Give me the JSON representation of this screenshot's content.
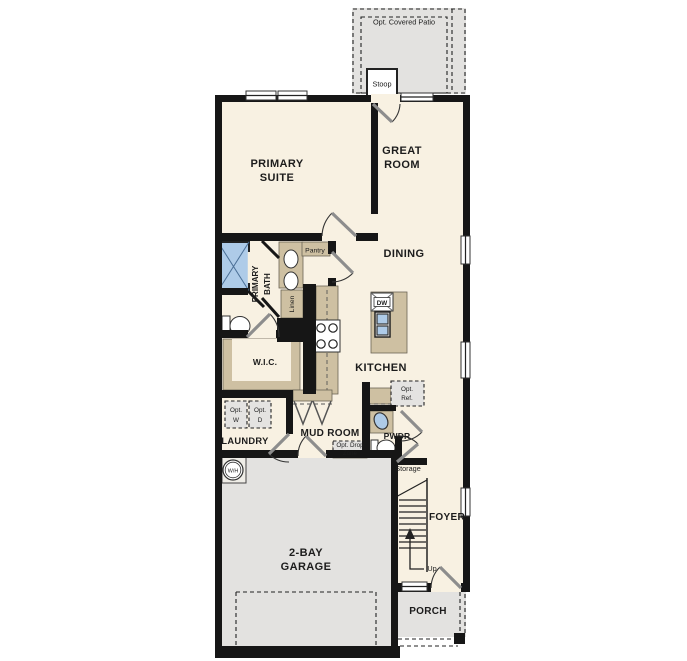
{
  "plan": {
    "rooms": {
      "primary_suite": {
        "line1": "PRIMARY",
        "line2": "SUITE"
      },
      "great_room": {
        "line1": "GREAT",
        "line2": "ROOM"
      },
      "dining": {
        "label": "DINING"
      },
      "kitchen": {
        "label": "KITCHEN"
      },
      "primary_bath": {
        "word1": "PRIMARY",
        "word2": "BATH"
      },
      "pantry": {
        "label": "Pantry"
      },
      "linen": {
        "label": "Linen"
      },
      "wic": {
        "label": "W.I.C."
      },
      "laundry": {
        "label": "LAUNDRY"
      },
      "mud_room": {
        "label": "MUD ROOM"
      },
      "pwdr": {
        "label": "PWDR"
      },
      "storage": {
        "label": "Storage"
      },
      "foyer": {
        "label": "FOYER"
      },
      "garage": {
        "line1": "2-BAY",
        "line2": "GARAGE"
      },
      "porch": {
        "label": "PORCH"
      },
      "stoop": {
        "label": "Stoop"
      }
    },
    "options": {
      "covered_patio": "Opt. Covered Patio",
      "washer": {
        "line1": "Opt.",
        "line2": "W"
      },
      "dryer": {
        "line1": "Opt.",
        "line2": "D"
      },
      "drop_zone": {
        "line1": "Opt. Drop",
        "line2": "Zone"
      },
      "refrigerator": {
        "line1": "Opt.",
        "line2": "Ref."
      }
    },
    "fixtures": {
      "dishwasher": "DW",
      "water_heater": "W/H"
    },
    "stairs": {
      "direction": "Up"
    },
    "colors": {
      "background": "#ffffff",
      "floor": "#f8f1e2",
      "wall": "#161616",
      "cabinet": "#cec0a2",
      "garage_floor": "#e3e2e0",
      "fixture_blue": "#aecbe8"
    }
  }
}
